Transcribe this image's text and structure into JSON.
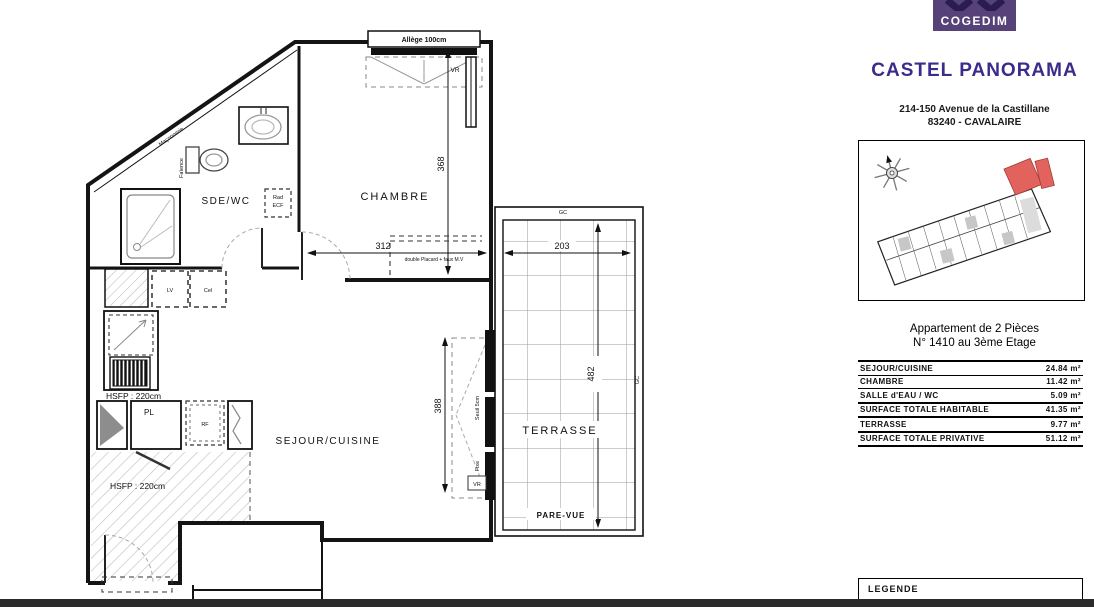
{
  "header": {
    "logo_text": "COGEDIM",
    "title": "CASTEL PANORAMA",
    "address_line1": "214-150 Avenue de la Castillane",
    "address_line2": "83240 - CAVALAIRE"
  },
  "apartment": {
    "line1": "Appartement de 2 Pièces",
    "line2": "N° 1410 au 3ème Etage"
  },
  "surface_table": {
    "rows": [
      {
        "label": "SEJOUR/CUISINE",
        "value": "24.84 m²"
      },
      {
        "label": "CHAMBRE",
        "value": "11.42 m²"
      },
      {
        "label": "SALLE d'EAU / WC",
        "value": "5.09 m²"
      },
      {
        "label": "SURFACE TOTALE HABITABLE",
        "value": "41.35 m²"
      },
      {
        "label": "TERRASSE",
        "value": "9.77 m²"
      },
      {
        "label": "SURFACE TOTALE PRIVATIVE",
        "value": "51.12 m²"
      }
    ]
  },
  "legend": {
    "title": "LEGENDE"
  },
  "plan": {
    "window_label": "Allège 100cm",
    "vr_top": "VR",
    "vr_bay": "VR",
    "room_sde": "SDE/WC",
    "room_chambre": "CHAMBRE",
    "room_sejour": "SEJOUR/CUISINE",
    "room_terrasse": "TERRASSE",
    "pare_vue": "PARE-VUE",
    "dim_368": "368",
    "dim_312": "312",
    "dim_388": "388",
    "dim_203": "203",
    "dim_482": "482",
    "hsfp_kitchen": "HSFP : 220cm",
    "hsfp_entry": "HSFP : 220cm",
    "pl": "PL",
    "rf": "RF",
    "lv": "LV",
    "cel": "Cel",
    "rad_line1": "Rad",
    "rad_line2": "ECF",
    "faience": "Faïence",
    "maconnerie": "Maçonnerie",
    "placard_note": "double Placard + faux M.V",
    "seuil": "Seuil 5cm",
    "fixe": "Fixe",
    "gc_top": "GC",
    "gc_right": "GC"
  },
  "colors": {
    "brand_purple": "#3c2b8c",
    "logo_background": "#564279",
    "highlight_red": "#e2635e"
  }
}
